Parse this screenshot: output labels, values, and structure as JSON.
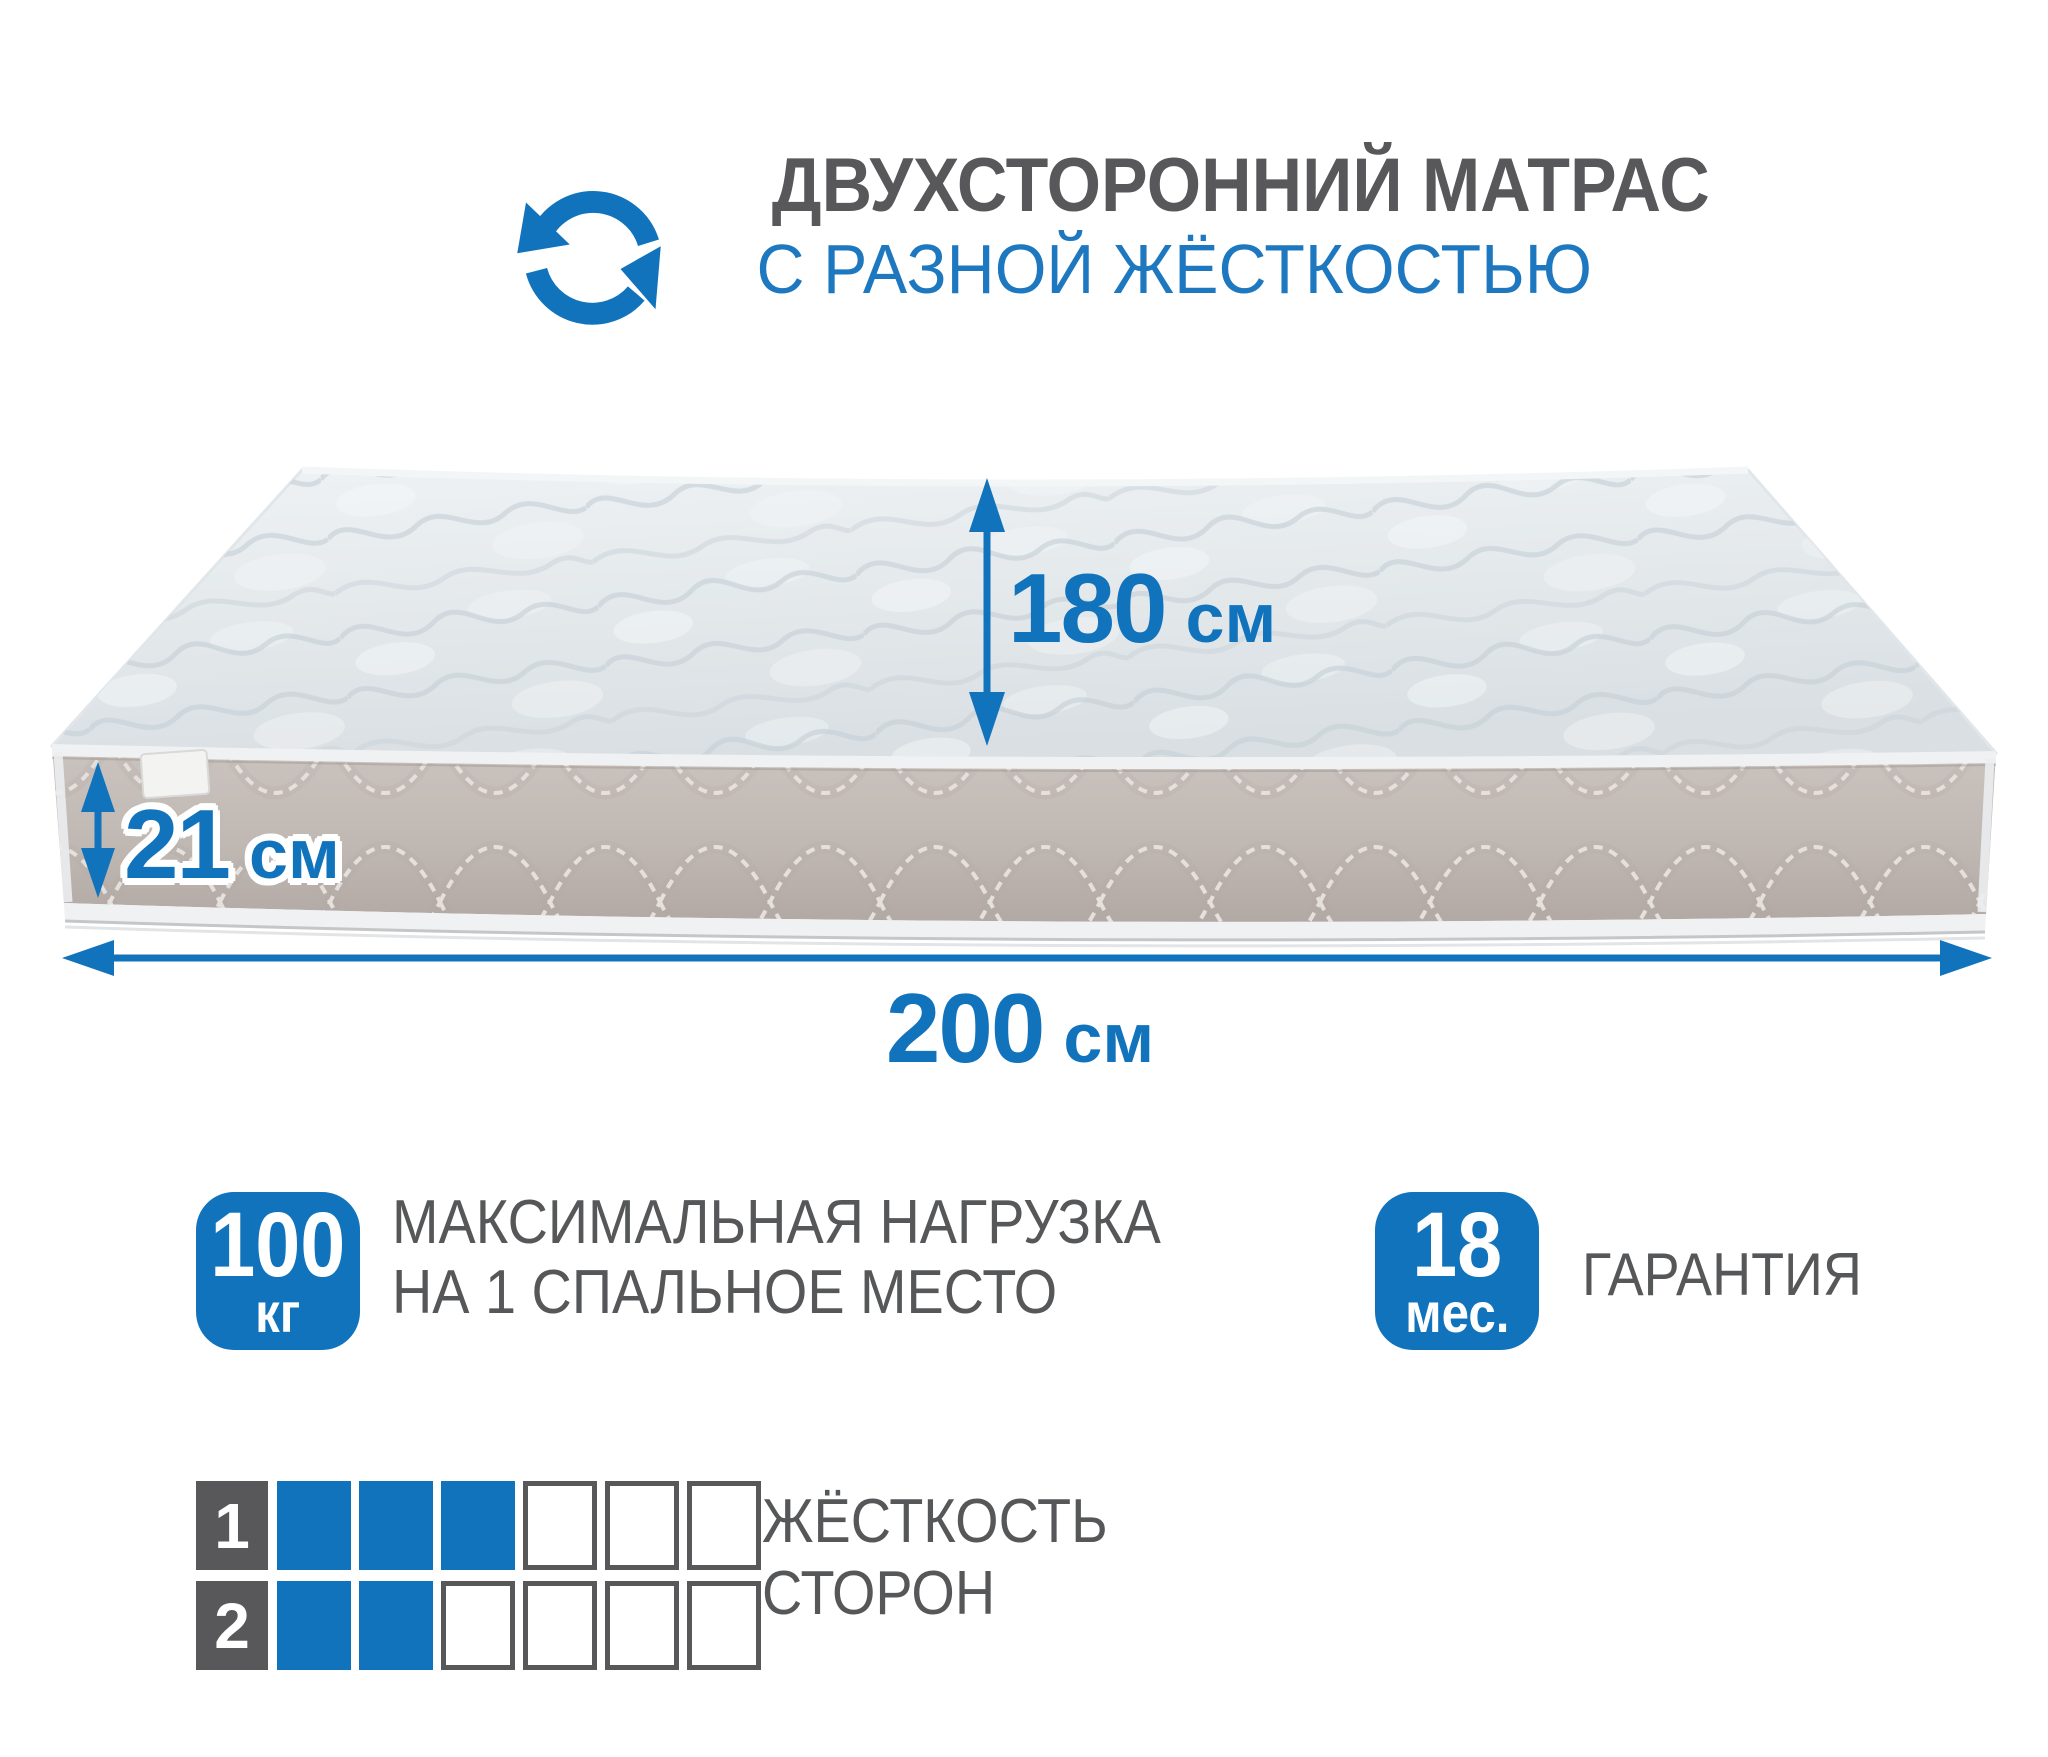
{
  "colors": {
    "accent_blue": "#1173bc",
    "title_blue": "#1e78c0",
    "text_gray": "#565759",
    "cell_gray": "#58585a",
    "mattress_top": "#e3e8ec",
    "mattress_side": "#bfb7b2"
  },
  "header": {
    "icon": "rotate-arrows-icon",
    "title": "ДВУХСТОРОННИЙ МАТРАС",
    "subtitle": "С РАЗНОЙ ЖЁСТКОСТЬЮ"
  },
  "dimensions": {
    "depth": {
      "value": "180",
      "unit": "см"
    },
    "thickness": {
      "value": "21",
      "unit": "см"
    },
    "length": {
      "value": "200",
      "unit": "см"
    }
  },
  "features": {
    "max_load": {
      "badge_value": "100",
      "badge_unit": "кг",
      "label_line1": "МАКСИМАЛЬНАЯ НАГРУЗКА",
      "label_line2": "НА 1 СПАЛЬНОЕ МЕСТО"
    },
    "warranty": {
      "badge_value": "18",
      "badge_unit": "мес.",
      "label": "ГАРАНТИЯ"
    }
  },
  "firmness": {
    "label_line1": "ЖЁСТКОСТЬ",
    "label_line2": "СТОРОН",
    "rows": [
      {
        "side": "1",
        "filled": 3,
        "total": 6
      },
      {
        "side": "2",
        "filled": 2,
        "total": 6
      }
    ]
  }
}
